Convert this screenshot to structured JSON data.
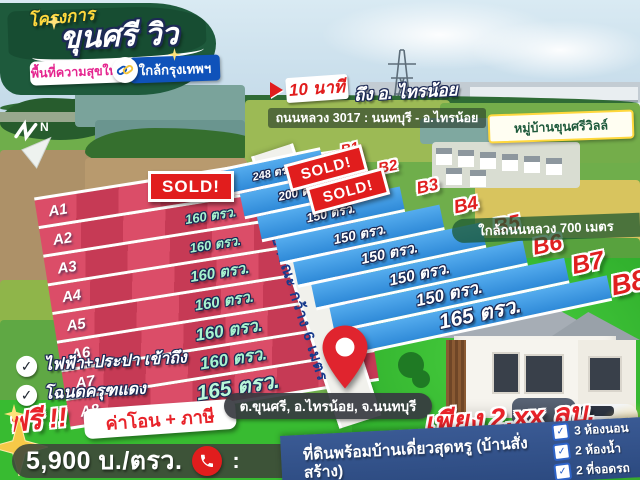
{
  "colors": {
    "brand_green": "#1e5a3c",
    "plot_red": "#d84663",
    "plot_blue": "#3b97e3",
    "sold_red": "#e11d1d",
    "accent_pink": "#e5258f",
    "accent_blue": "#0f52ba",
    "price_red": "#e8232a",
    "grass_green": "#3ec437",
    "band_navy": "#33548c",
    "gold": "#ffd83d"
  },
  "icons": {
    "check": "✓"
  },
  "header": {
    "project_label": "โครงการ",
    "title": "ขุนศรี วิว",
    "tagline_left": "พื้นที่ความสุขใหม่",
    "tagline_right": "ใกล้กรุงเทพฯ"
  },
  "callouts": {
    "minutes_badge": "10 นาที",
    "minutes_rest": "ถึง อ. ไทรน้อย",
    "highway_line": "ถนนหลวง 3017 : นนทบุรี - อ.ไทรน้อย",
    "village_box": "หมู่บ้านขุนศรีวิลล์",
    "near_road_band": "ใกล้ถนนหลวง 700 เมตร",
    "north_indicator": "N"
  },
  "plot_map": {
    "road_label": "ถนนสาธารณะ กว้าง 6 เมตร",
    "sold_label": "SOLD!",
    "section_a": [
      {
        "id": "A1",
        "size": ""
      },
      {
        "id": "A2",
        "size": "160 ตรว."
      },
      {
        "id": "A3",
        "size": "160 ตรว."
      },
      {
        "id": "A4",
        "size": "160 ตรว."
      },
      {
        "id": "A5",
        "size": "160 ตรว."
      },
      {
        "id": "A6",
        "size": "160 ตรว."
      },
      {
        "id": "A7",
        "size": "160 ตรว."
      },
      {
        "id": "A8",
        "size": "165 ตรว."
      }
    ],
    "section_b": [
      {
        "id": "B1",
        "size": "248 ตรว."
      },
      {
        "id": "B2",
        "size": "200 ตรว."
      },
      {
        "id": "B3",
        "size": "150 ตรว."
      },
      {
        "id": "B4",
        "size": "150 ตรว."
      },
      {
        "id": "B5",
        "size": "150 ตรว."
      },
      {
        "id": "B6",
        "size": "150 ตรว."
      },
      {
        "id": "B7",
        "size": "150 ตรว."
      },
      {
        "id": "B8",
        "size": "165 ตรว."
      }
    ]
  },
  "features": {
    "item1": "ไฟฟ้า+ประปา เข้าถึง",
    "item2": "โฉนดครุฑแดง"
  },
  "promo": {
    "free_label": "ฟรี !!",
    "free_items": "ค่าโอน + ภาษี"
  },
  "pricing": {
    "per_wah": "5,900 บ./ตรว.",
    "after_phone": ":"
  },
  "location": {
    "pill": "ต.ขุนศรี, อ.ไทรน้อย, จ.นนทบุรี"
  },
  "offer": {
    "headline": "เพียง 2.xx ลบ.",
    "description": "ที่ดินพร้อมบ้านเดี่ยวสุดหรู (บ้านสั่งสร้าง)",
    "house_features": [
      {
        "label": "3 ห้องนอน"
      },
      {
        "label": "2 ห้องน้ำ"
      },
      {
        "label": "2 ที่จอดรถ"
      }
    ]
  }
}
